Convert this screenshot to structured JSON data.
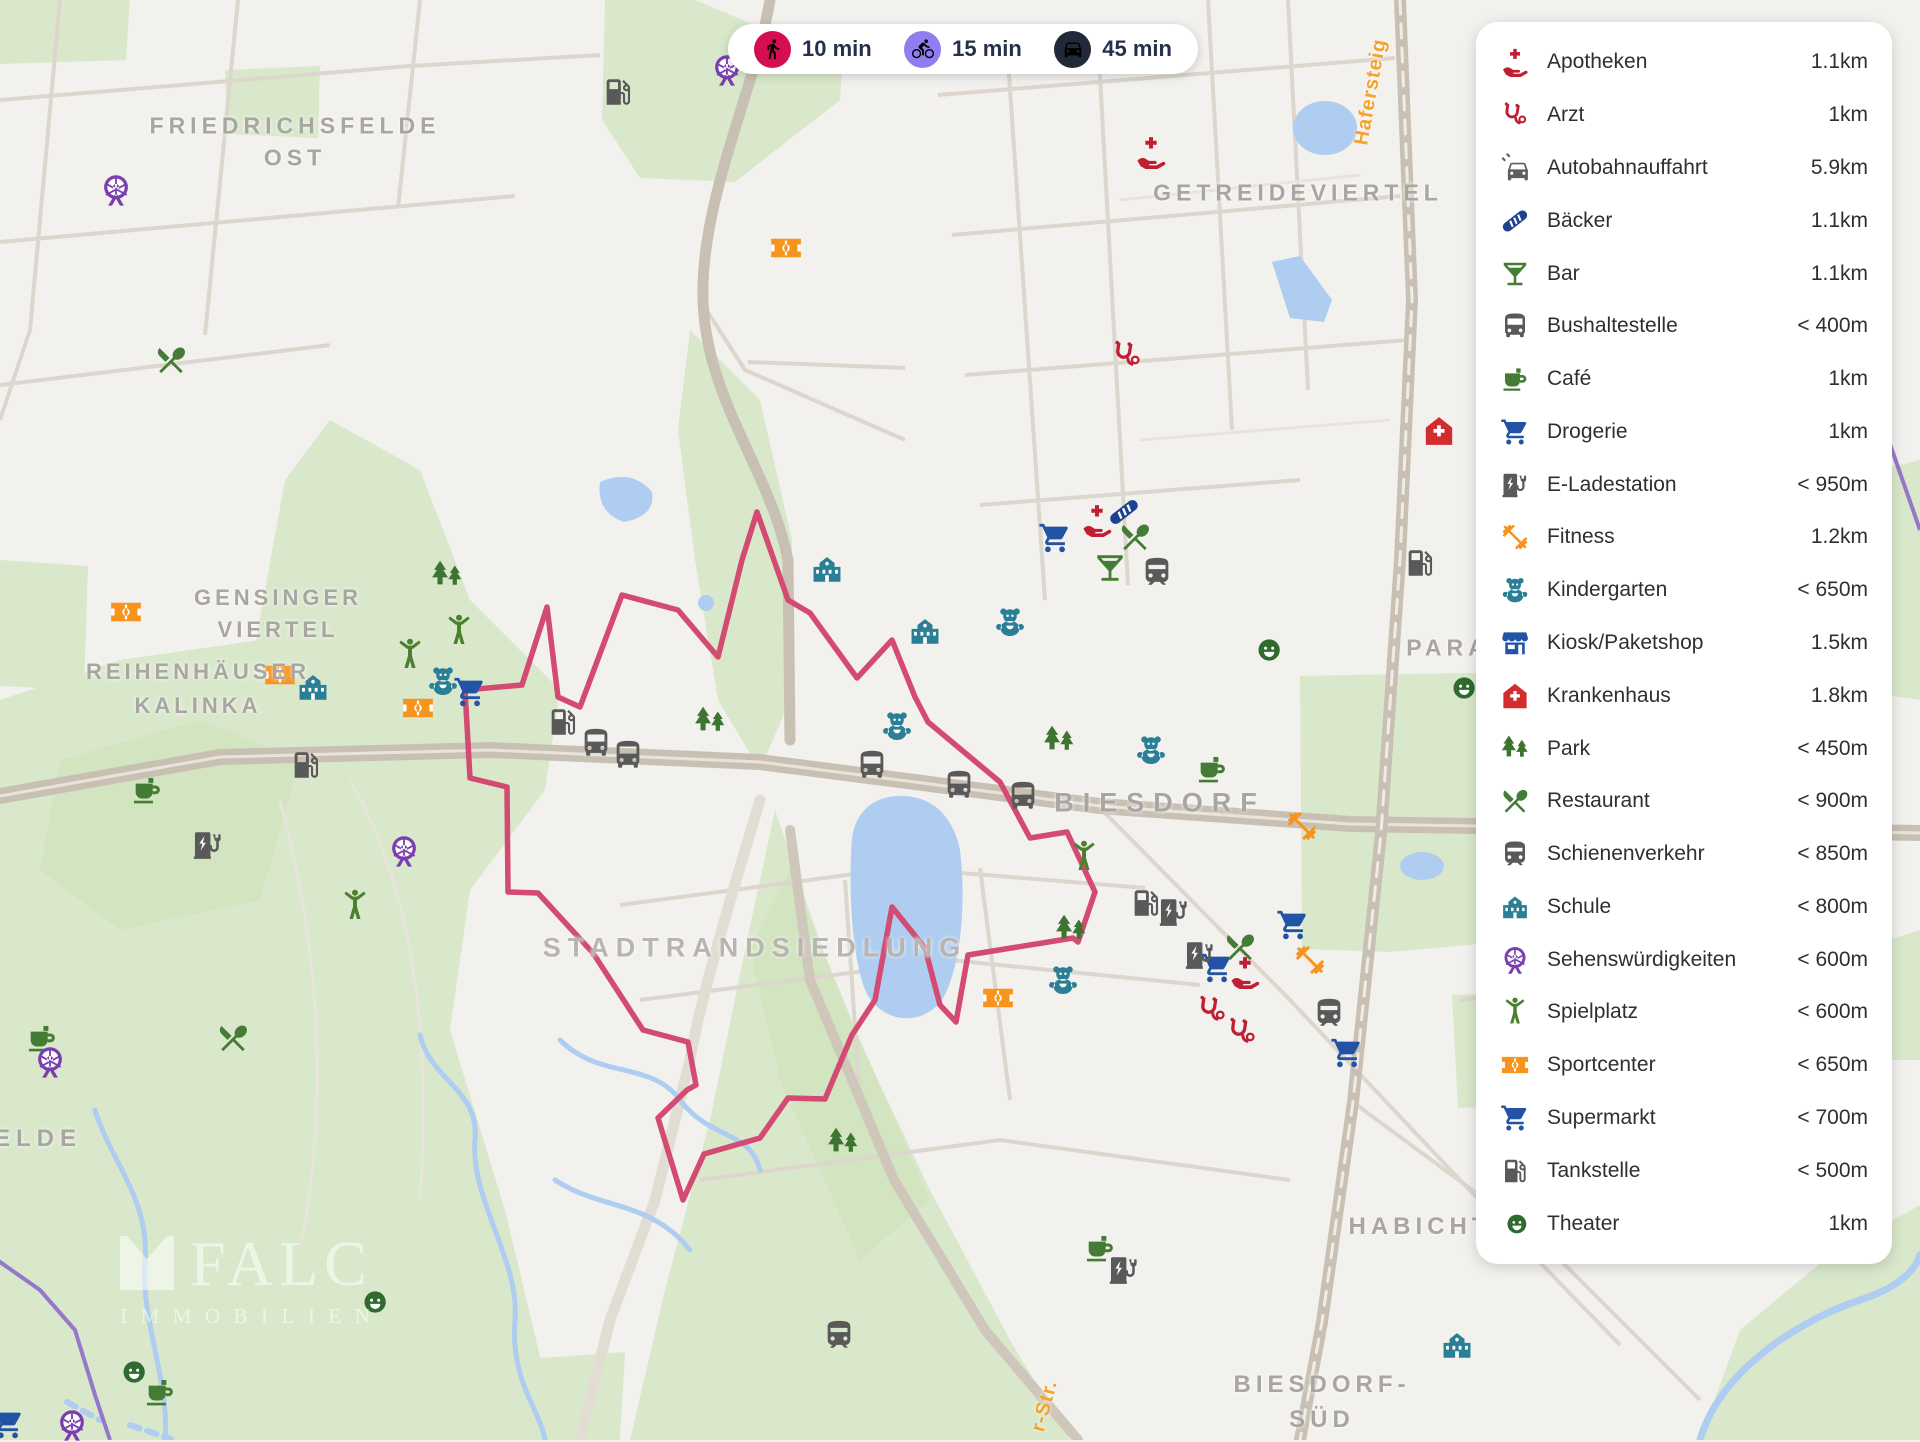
{
  "travel_times": {
    "modes": [
      {
        "icon": "walk",
        "label": "10 min",
        "color": "#d40e52"
      },
      {
        "icon": "bike",
        "label": "15 min",
        "color": "#8f7ef0"
      },
      {
        "icon": "car",
        "label": "45 min",
        "color": "#202a38"
      }
    ]
  },
  "sidebar": {
    "items": [
      {
        "icon": "apotheke",
        "label": "Apotheken",
        "distance": "1.1km"
      },
      {
        "icon": "stetho",
        "label": "Arzt",
        "distance": "1km"
      },
      {
        "icon": "carside",
        "label": "Autobahnauffahrt",
        "distance": "5.9km"
      },
      {
        "icon": "bread",
        "label": "Bäcker",
        "distance": "1.1km"
      },
      {
        "icon": "martini",
        "label": "Bar",
        "distance": "1.1km"
      },
      {
        "icon": "bus",
        "label": "Bushaltestelle",
        "distance": "< 400m"
      },
      {
        "icon": "coffee",
        "label": "Café",
        "distance": "1km"
      },
      {
        "icon": "cart",
        "label": "Drogerie",
        "distance": "1km"
      },
      {
        "icon": "ev",
        "label": "E-Ladestation",
        "distance": "< 950m"
      },
      {
        "icon": "dumbbell",
        "label": "Fitness",
        "distance": "1.2km"
      },
      {
        "icon": "teddy",
        "label": "Kindergarten",
        "distance": "< 650m"
      },
      {
        "icon": "kiosk",
        "label": "Kiosk/Paketshop",
        "distance": "1.5km"
      },
      {
        "icon": "hospital",
        "label": "Krankenhaus",
        "distance": "1.8km"
      },
      {
        "icon": "trees",
        "label": "Park",
        "distance": "< 450m"
      },
      {
        "icon": "restaurant",
        "label": "Restaurant",
        "distance": "< 900m"
      },
      {
        "icon": "train",
        "label": "Schienenverkehr",
        "distance": "< 850m"
      },
      {
        "icon": "school",
        "label": "Schule",
        "distance": "< 800m"
      },
      {
        "icon": "ferris",
        "label": "Sehenswürdigkeiten",
        "distance": "< 600m"
      },
      {
        "icon": "figure",
        "label": "Spielplatz",
        "distance": "< 600m"
      },
      {
        "icon": "sport",
        "label": "Sportcenter",
        "distance": "< 650m"
      },
      {
        "icon": "cart",
        "label": "Supermarkt",
        "distance": "< 700m"
      },
      {
        "icon": "fuel",
        "label": "Tankstelle",
        "distance": "< 500m"
      },
      {
        "icon": "masks",
        "label": "Theater",
        "distance": "1km"
      }
    ]
  },
  "icon_colors": {
    "apotheke": "#c01f33",
    "stetho": "#bf1f32",
    "carside": "#5b5e62",
    "bread": "#1d4291",
    "martini": "#457c35",
    "bus": "#595959",
    "coffee": "#457c35",
    "cart": "#2353a5",
    "ev": "#595959",
    "dumbbell": "#f7941d",
    "teddy": "#2a7f96",
    "kiosk": "#2353a5",
    "hospital": "#d22d2d",
    "trees": "#3c7430",
    "restaurant": "#457c35",
    "train": "#595959",
    "school": "#2a7f96",
    "ferris": "#7a3fae",
    "figure": "#4a8030",
    "sport": "#f7941d",
    "fuel": "#595959",
    "masks": "#2f6b2f"
  },
  "watermark": {
    "brand": "FALC",
    "sub": "IMMOBILIEN"
  },
  "map": {
    "route_color": "#d34a72",
    "route_points": [
      [
        956,
        1022
      ],
      [
        968,
        955
      ],
      [
        1073,
        938
      ],
      [
        1078,
        942
      ],
      [
        1095,
        892
      ],
      [
        1067,
        832
      ],
      [
        1030,
        838
      ],
      [
        1000,
        782
      ],
      [
        928,
        722
      ],
      [
        915,
        697
      ],
      [
        892,
        640
      ],
      [
        857,
        678
      ],
      [
        810,
        613
      ],
      [
        788,
        600
      ],
      [
        757,
        512
      ],
      [
        742,
        560
      ],
      [
        718,
        657
      ],
      [
        678,
        610
      ],
      [
        622,
        595
      ],
      [
        580,
        707
      ],
      [
        558,
        697
      ],
      [
        547,
        607
      ],
      [
        522,
        685
      ],
      [
        465,
        690
      ],
      [
        470,
        778
      ],
      [
        507,
        787
      ],
      [
        508,
        892
      ],
      [
        538,
        893
      ],
      [
        593,
        953
      ],
      [
        643,
        1030
      ],
      [
        688,
        1042
      ],
      [
        696,
        1085
      ],
      [
        687,
        1090
      ],
      [
        658,
        1118
      ],
      [
        683,
        1200
      ],
      [
        704,
        1154
      ],
      [
        760,
        1138
      ],
      [
        788,
        1098
      ],
      [
        825,
        1099
      ],
      [
        852,
        1035
      ],
      [
        875,
        1000
      ],
      [
        892,
        907
      ],
      [
        925,
        948
      ],
      [
        940,
        1005
      ],
      [
        956,
        1022
      ]
    ],
    "labels": [
      {
        "text": "FRIEDRICHSFELDE",
        "x": 295,
        "y": 126,
        "size": 23,
        "ls": 5
      },
      {
        "text": "OST",
        "x": 295,
        "y": 158,
        "size": 23,
        "ls": 5
      },
      {
        "text": "GETREIDEVIERTEL",
        "x": 1298,
        "y": 193,
        "size": 23,
        "ls": 5
      },
      {
        "text": "GENSINGER",
        "x": 278,
        "y": 598,
        "size": 22,
        "ls": 4
      },
      {
        "text": "VIERTEL",
        "x": 278,
        "y": 630,
        "size": 22,
        "ls": 4
      },
      {
        "text": "REIHENHÄUSER",
        "x": 198,
        "y": 672,
        "size": 22,
        "ls": 4
      },
      {
        "text": "KALINKA",
        "x": 198,
        "y": 706,
        "size": 22,
        "ls": 4
      },
      {
        "text": "STADTRANDSIEDLUNG",
        "x": 755,
        "y": 948,
        "size": 27,
        "ls": 7,
        "color": "#b8b5b0"
      },
      {
        "text": "BIESDORF",
        "x": 1160,
        "y": 803,
        "size": 27,
        "ls": 9
      },
      {
        "text": "BIESDORF-",
        "x": 1322,
        "y": 1385,
        "size": 24,
        "ls": 5
      },
      {
        "text": "SÜD",
        "x": 1322,
        "y": 1420,
        "size": 24,
        "ls": 5
      },
      {
        "text": "HABICHT",
        "x": 1420,
        "y": 1227,
        "size": 24,
        "ls": 5
      },
      {
        "text": "ELDE",
        "x": 38,
        "y": 1139,
        "size": 24,
        "ls": 6
      },
      {
        "text": "PARA",
        "x": 1448,
        "y": 648,
        "size": 23,
        "ls": 5
      },
      {
        "text": "Hafersteig",
        "x": 1371,
        "y": 92,
        "size": 20,
        "ls": 1,
        "rot": -80,
        "street": true
      },
      {
        "text": "r-Str.",
        "x": 1045,
        "y": 1406,
        "size": 20,
        "ls": 1,
        "rot": -75,
        "street": true
      }
    ],
    "pois": [
      {
        "t": "ferris",
        "x": 116,
        "y": 190
      },
      {
        "t": "fuel",
        "x": 618,
        "y": 92
      },
      {
        "t": "ferris",
        "x": 727,
        "y": 70
      },
      {
        "t": "restaurant",
        "x": 171,
        "y": 360
      },
      {
        "t": "apotheke",
        "x": 1151,
        "y": 152
      },
      {
        "t": "sport",
        "x": 786,
        "y": 248
      },
      {
        "t": "stetho",
        "x": 1127,
        "y": 355
      },
      {
        "t": "hospital",
        "x": 1439,
        "y": 431
      },
      {
        "t": "cart",
        "x": 1055,
        "y": 538
      },
      {
        "t": "apotheke",
        "x": 1097,
        "y": 520
      },
      {
        "t": "bread",
        "x": 1124,
        "y": 512
      },
      {
        "t": "restaurant",
        "x": 1135,
        "y": 537
      },
      {
        "t": "martini",
        "x": 1110,
        "y": 568
      },
      {
        "t": "train",
        "x": 1157,
        "y": 572
      },
      {
        "t": "school",
        "x": 827,
        "y": 569
      },
      {
        "t": "school",
        "x": 925,
        "y": 631
      },
      {
        "t": "teddy",
        "x": 1010,
        "y": 622
      },
      {
        "t": "trees",
        "x": 447,
        "y": 576
      },
      {
        "t": "figure",
        "x": 459,
        "y": 631
      },
      {
        "t": "figure",
        "x": 410,
        "y": 655
      },
      {
        "t": "teddy",
        "x": 443,
        "y": 681
      },
      {
        "t": "cart",
        "x": 470,
        "y": 692
      },
      {
        "t": "sport",
        "x": 126,
        "y": 612
      },
      {
        "t": "sport",
        "x": 280,
        "y": 675
      },
      {
        "t": "school",
        "x": 313,
        "y": 687
      },
      {
        "t": "sport",
        "x": 418,
        "y": 708
      },
      {
        "t": "fuel",
        "x": 306,
        "y": 765
      },
      {
        "t": "fuel",
        "x": 563,
        "y": 722
      },
      {
        "t": "bus",
        "x": 596,
        "y": 743
      },
      {
        "t": "bus",
        "x": 628,
        "y": 755
      },
      {
        "t": "bus",
        "x": 872,
        "y": 765
      },
      {
        "t": "bus",
        "x": 959,
        "y": 785
      },
      {
        "t": "bus",
        "x": 1023,
        "y": 796
      },
      {
        "t": "trees",
        "x": 710,
        "y": 722
      },
      {
        "t": "trees",
        "x": 1059,
        "y": 741
      },
      {
        "t": "teddy",
        "x": 897,
        "y": 726
      },
      {
        "t": "teddy",
        "x": 1151,
        "y": 750
      },
      {
        "t": "coffee",
        "x": 1212,
        "y": 769
      },
      {
        "t": "masks",
        "x": 1267,
        "y": 650
      },
      {
        "t": "masks",
        "x": 1462,
        "y": 688
      },
      {
        "t": "fuel",
        "x": 1420,
        "y": 563
      },
      {
        "t": "dumbbell",
        "x": 1302,
        "y": 826
      },
      {
        "t": "coffee",
        "x": 147,
        "y": 790
      },
      {
        "t": "ev",
        "x": 208,
        "y": 845
      },
      {
        "t": "ferris",
        "x": 404,
        "y": 851
      },
      {
        "t": "figure",
        "x": 355,
        "y": 906
      },
      {
        "t": "figure",
        "x": 1084,
        "y": 857
      },
      {
        "t": "trees",
        "x": 1071,
        "y": 930
      },
      {
        "t": "fuel",
        "x": 1146,
        "y": 903
      },
      {
        "t": "ev",
        "x": 1174,
        "y": 912
      },
      {
        "t": "cart",
        "x": 1293,
        "y": 925
      },
      {
        "t": "cart",
        "x": 1217,
        "y": 968
      },
      {
        "t": "restaurant",
        "x": 1240,
        "y": 947
      },
      {
        "t": "apotheke",
        "x": 1245,
        "y": 972
      },
      {
        "t": "ev",
        "x": 1200,
        "y": 955
      },
      {
        "t": "dumbbell",
        "x": 1310,
        "y": 960
      },
      {
        "t": "stetho",
        "x": 1212,
        "y": 1010
      },
      {
        "t": "stetho",
        "x": 1242,
        "y": 1032
      },
      {
        "t": "train",
        "x": 1329,
        "y": 1013
      },
      {
        "t": "sport",
        "x": 998,
        "y": 998
      },
      {
        "t": "teddy",
        "x": 1063,
        "y": 980
      },
      {
        "t": "trees",
        "x": 843,
        "y": 1143
      },
      {
        "t": "coffee",
        "x": 1100,
        "y": 1248
      },
      {
        "t": "ev",
        "x": 1124,
        "y": 1270
      },
      {
        "t": "cart",
        "x": 1347,
        "y": 1053
      },
      {
        "t": "train",
        "x": 839,
        "y": 1335
      },
      {
        "t": "masks",
        "x": 373,
        "y": 1302
      },
      {
        "t": "coffee",
        "x": 42,
        "y": 1038
      },
      {
        "t": "ferris",
        "x": 50,
        "y": 1062
      },
      {
        "t": "restaurant",
        "x": 233,
        "y": 1038
      },
      {
        "t": "masks",
        "x": 132,
        "y": 1372
      },
      {
        "t": "coffee",
        "x": 160,
        "y": 1392
      },
      {
        "t": "ferris",
        "x": 72,
        "y": 1425
      },
      {
        "t": "cart",
        "x": 8,
        "y": 1424
      },
      {
        "t": "school",
        "x": 1457,
        "y": 1345
      }
    ]
  }
}
